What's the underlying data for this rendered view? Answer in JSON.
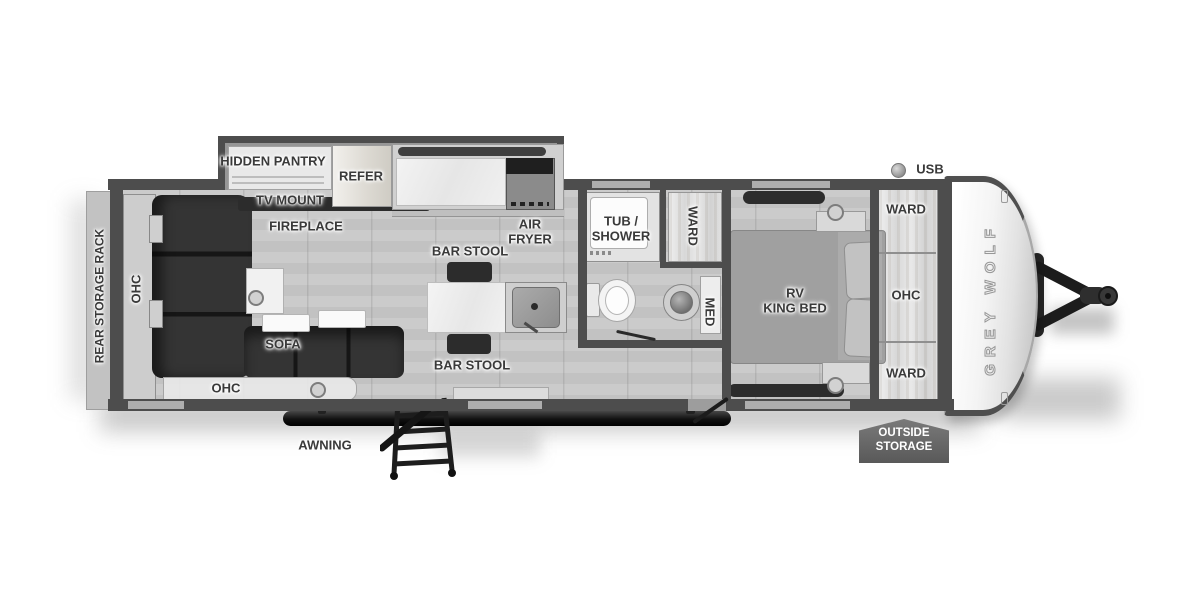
{
  "document": {
    "type": "RV floor plan",
    "model": "Grey Wolf travel trailer floor plan (black & white)"
  },
  "brand": {
    "name": "GREY WOLF"
  },
  "colors": {
    "wall": "#4d4d4d",
    "floor": "#c7c7c7",
    "sofa": "#2c2c2c",
    "label_text": "#3a3a3a",
    "badge_bg": "#5f5f5f",
    "front_cap": "#f4f4f4"
  },
  "labels": {
    "rear_storage_rack": "REAR STORAGE RACK",
    "ohc_left": "OHC",
    "ohc_bottom": "OHC",
    "sofa": "SOFA",
    "awning": "AWNING",
    "hidden_pantry": "HIDDEN PANTRY",
    "tv_mount": "TV MOUNT",
    "fireplace": "FIREPLACE",
    "refer": "REFER",
    "air_fryer": "AIR\nFRYER",
    "bar_stool_top": "BAR STOOL",
    "bar_stool_bottom": "BAR STOOL",
    "tub_shower": "TUB /\nSHOWER",
    "ward_bath": "WARD",
    "med": "MED",
    "rv_king_bed": "RV\nKING BED",
    "ward_top": "WARD",
    "ohc_bedroom": "OHC",
    "ward_bottom": "WARD",
    "usb": "USB",
    "outside_storage": "OUTSIDE\nSTORAGE"
  }
}
